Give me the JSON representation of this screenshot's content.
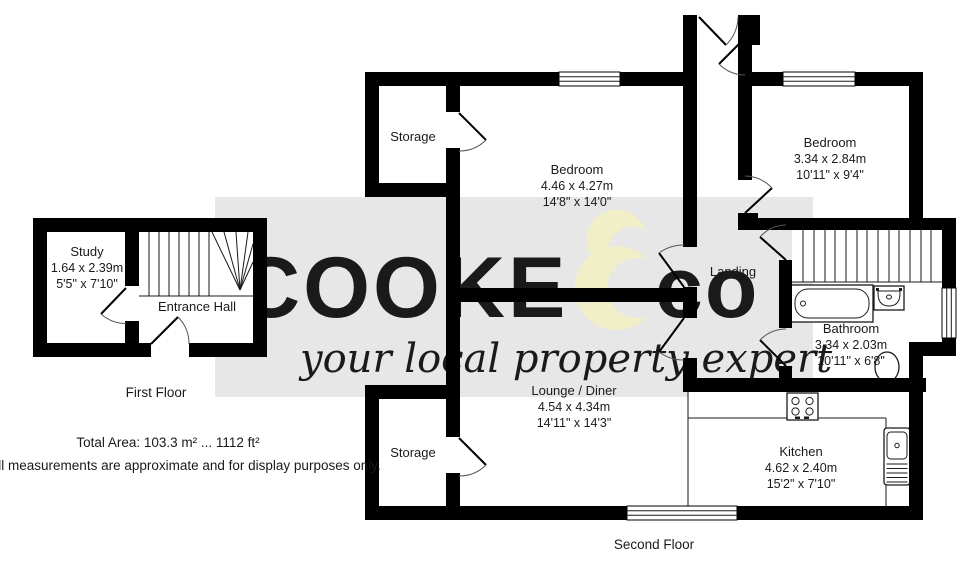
{
  "watermark": {
    "band_color": "#e7e7e7",
    "word_left": "COOKE",
    "word_right": "co",
    "word_color": "#f6f6f6",
    "accent_color": "#f1efc7",
    "tagline": "your local property expert"
  },
  "floor_first": {
    "label": "First Floor",
    "study": {
      "name": "Study",
      "metric": "1.64 x 2.39m",
      "imperial": "5'5\" x 7'10\""
    },
    "hall": {
      "name": "Entrance Hall"
    }
  },
  "floor_second": {
    "label": "Second Floor",
    "storage_top": {
      "name": "Storage"
    },
    "storage_bottom": {
      "name": "Storage"
    },
    "bedroom_main": {
      "name": "Bedroom",
      "metric": "4.46 x 4.27m",
      "imperial": "14'8\" x 14'0\""
    },
    "bedroom_second": {
      "name": "Bedroom",
      "metric": "3.34 x 2.84m",
      "imperial": "10'11\" x 9'4\""
    },
    "landing": {
      "name": "Landing"
    },
    "bathroom": {
      "name": "Bathroom",
      "metric": "3.34 x 2.03m",
      "imperial": "10'11\" x 6'8\""
    },
    "lounge": {
      "name": "Lounge / Diner",
      "metric": "4.54 x 4.34m",
      "imperial": "14'11\" x 14'3\""
    },
    "kitchen": {
      "name": "Kitchen",
      "metric": "4.62 x 2.40m",
      "imperial": "15'2\" x 7'10\""
    }
  },
  "footer": {
    "total_area": "Total Area: 103.3 m² ... 1112 ft²",
    "disclaimer": "All measurements are approximate and for display purposes only."
  }
}
